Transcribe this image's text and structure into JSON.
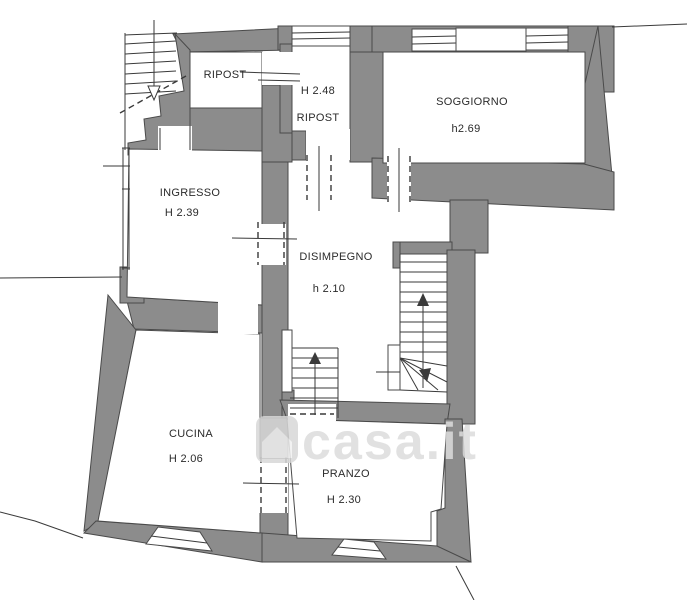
{
  "plan": {
    "type": "floor-plan",
    "rooms": {
      "ripost1": {
        "name": "RIPOST",
        "height": ""
      },
      "ripost2": {
        "name": "RIPOST",
        "height": "H 2.48"
      },
      "soggiorno": {
        "name": "SOGGIORNO",
        "height": "h2.69"
      },
      "ingresso": {
        "name": "INGRESSO",
        "height": "H 2.39"
      },
      "disimpegno": {
        "name": "DISIMPEGNO",
        "height": "h 2.10"
      },
      "cucina": {
        "name": "CUCINA",
        "height": "H 2.06"
      },
      "pranzo": {
        "name": "PRANZO",
        "height": "H 2.30"
      }
    },
    "stairs": {
      "exterior": {
        "icon": "down-arrow-icon"
      },
      "main": {
        "icon": "up-arrow-icon"
      },
      "small": {
        "icon": "up-arrow-icon"
      }
    },
    "watermark": {
      "text": "casa.it",
      "icon": "house-icon"
    },
    "colors": {
      "wall": "#8C8C8C",
      "wall_edge": "#4A4A4A",
      "line": "#3A3A3A",
      "background": "#FFFFFF",
      "watermark": "#DCDCDC"
    }
  }
}
